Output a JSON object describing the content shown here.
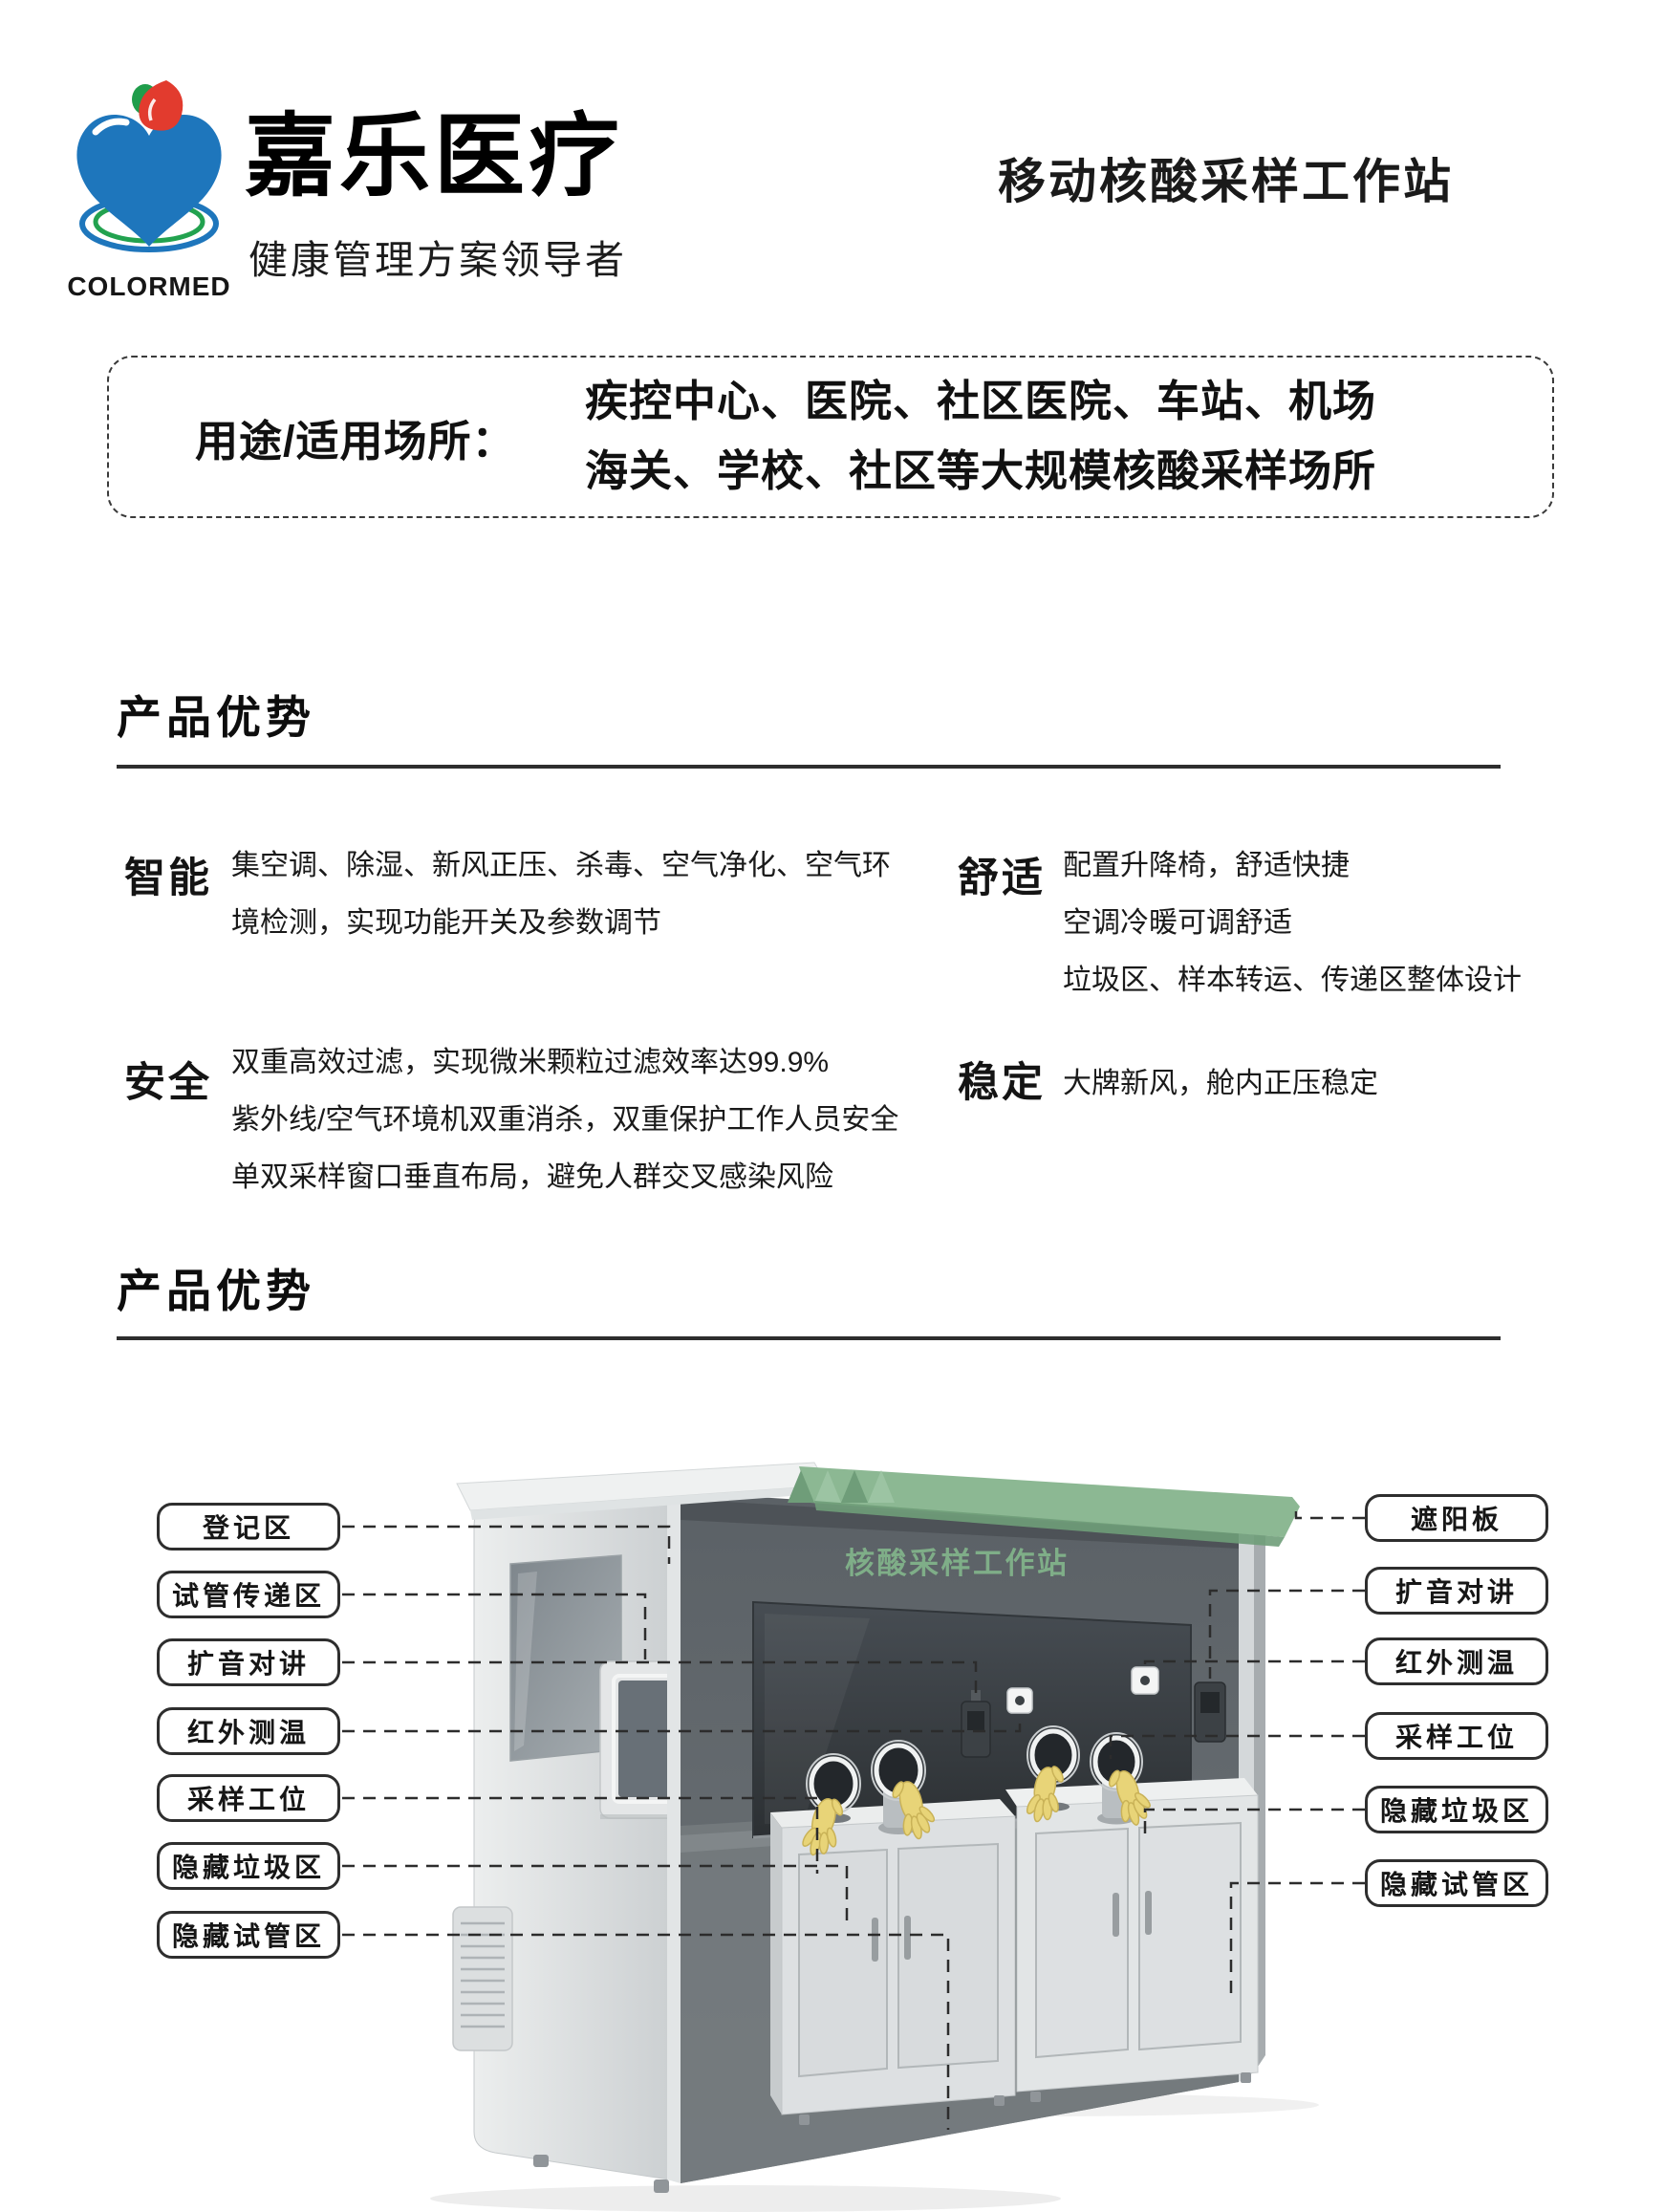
{
  "header": {
    "brand": "COLORMED",
    "company_name": "嘉乐医疗",
    "slogan": "健康管理方案领导者",
    "product_title": "移动核酸采样工作站"
  },
  "usage_box": {
    "label": "用途/适用场所：",
    "line1": "疾控中心、医院、社区医院、车站、机场",
    "line2": "海关、学校、社区等大规模核酸采样场所"
  },
  "section1": {
    "title": "产品优势"
  },
  "section2": {
    "title": "产品优势"
  },
  "features": [
    {
      "name": "智能",
      "desc": "集空调、除湿、新风正压、杀毒、空气净化、空气环\n境检测，实现功能开关及参数调节"
    },
    {
      "name": "舒适",
      "desc": "配置升降椅，舒适快捷\n空调冷暖可调舒适\n垃圾区、样本转运、传递区整体设计"
    },
    {
      "name": "安全",
      "desc": "双重高效过滤，实现微米颗粒过滤效率达99.9%\n紫外线/空气环境机双重消杀，双重保护工作人员安全\n单双采样窗口垂直布局，避免人群交叉感染风险"
    },
    {
      "name": "稳定",
      "desc": "大牌新风，舱内正压稳定"
    }
  ],
  "diagram": {
    "booth_title": "核酸采样工作站",
    "left_labels": [
      "登记区",
      "试管传递区",
      "扩音对讲",
      "红外测温",
      "采样工位",
      "隐藏垃圾区",
      "隐藏试管区"
    ],
    "right_labels": [
      "遮阳板",
      "扩音对讲",
      "红外测温",
      "采样工位",
      "隐藏垃圾区",
      "隐藏试管区"
    ],
    "colors": {
      "roof_green": "#8cb893",
      "roof_green_dark": "#6f9d79",
      "title_green": "#7fae88",
      "glove_yellow": "#e8d478",
      "logo_blue": "#1e76bc",
      "logo_red": "#e23b2e",
      "logo_green": "#1f9d4b"
    }
  }
}
